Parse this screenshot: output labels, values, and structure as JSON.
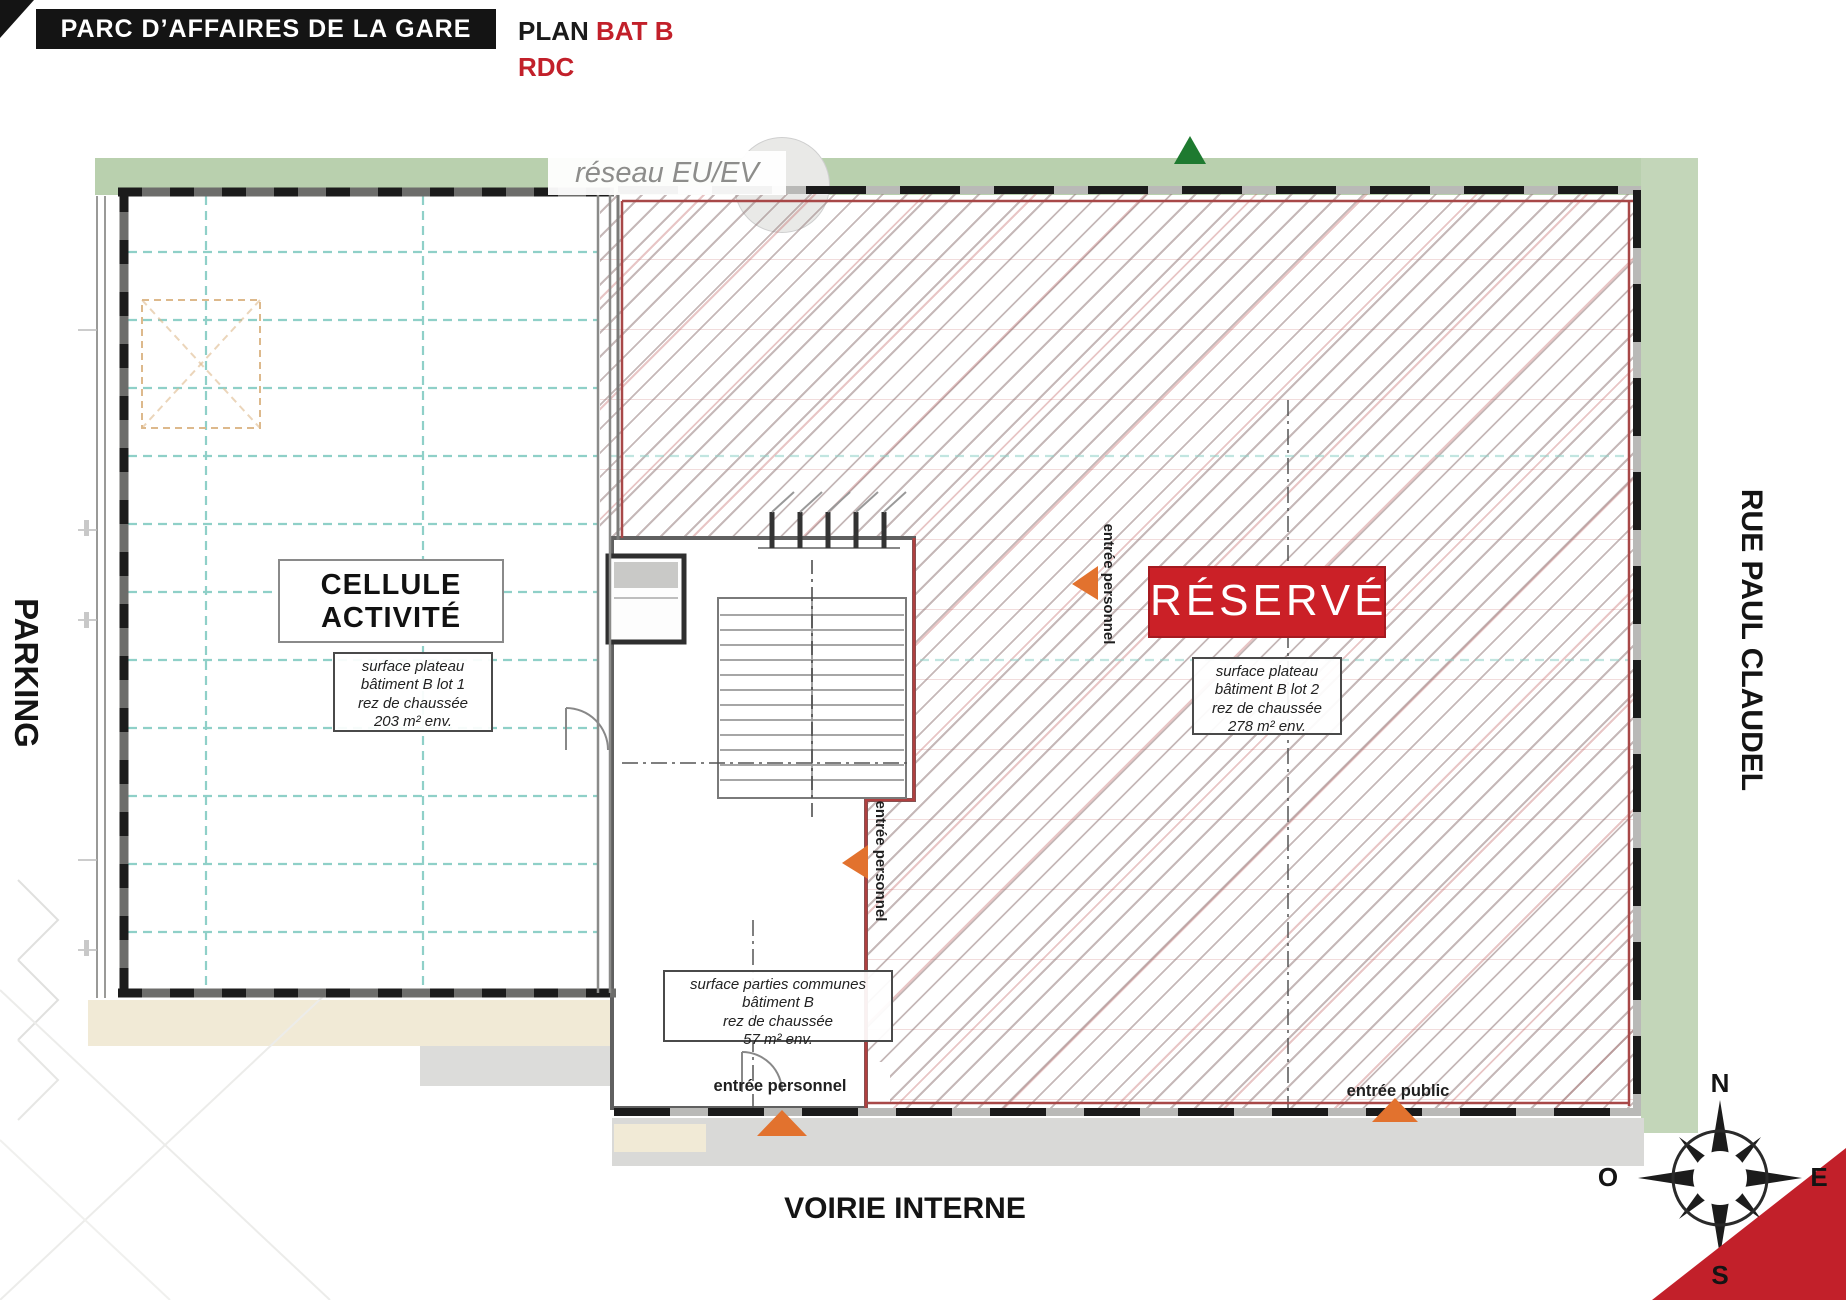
{
  "header": {
    "project_title": "PARC D’AFFAIRES DE LA GARE",
    "plan_word": "PLAN ",
    "building": "BAT B",
    "level": "RDC"
  },
  "surroundings": {
    "left_street": "PARKING",
    "right_street": "RUE PAUL CLAUDEL",
    "bottom_street": "VOIRIE INTERNE",
    "network_label": "réseau EU/EV"
  },
  "lot1": {
    "title_line1": "CELLULE",
    "title_line2": "ACTIVITÉ",
    "surface": {
      "l1": "surface plateau",
      "l2": "bâtiment B lot 1",
      "l3": "rez de chaussée",
      "l4": "203 m² env."
    }
  },
  "lot2": {
    "status": "RÉSERVÉ",
    "surface": {
      "l1": "surface plateau",
      "l2": "bâtiment B lot 2",
      "l3": "rez de chaussée",
      "l4": "278 m² env."
    }
  },
  "common_areas": {
    "surface": {
      "l1": "surface parties communes",
      "l2": "bâtiment B",
      "l3": "rez de chaussée",
      "l4": "57 m² env."
    }
  },
  "entrances": {
    "staff_upper": "entrée personnel",
    "staff_lower": "entrée personnel",
    "staff_bottom": "entrée personnel",
    "public": "entrée public"
  },
  "compass": {
    "north": "N",
    "south": "S",
    "east": "E",
    "west": "O"
  },
  "colors": {
    "accent_red": "#c2202a",
    "reserved_fill": "#cb2027",
    "banner_black": "#141414",
    "landscape_green": "#b9d0ae",
    "grid_teal": "#8fd0c8",
    "wall_gray": "#4c4c4a",
    "arrow_orange": "#e2722e",
    "walkway_beige": "#f1ead6",
    "sidewalk_gray": "#d9d9d7"
  }
}
